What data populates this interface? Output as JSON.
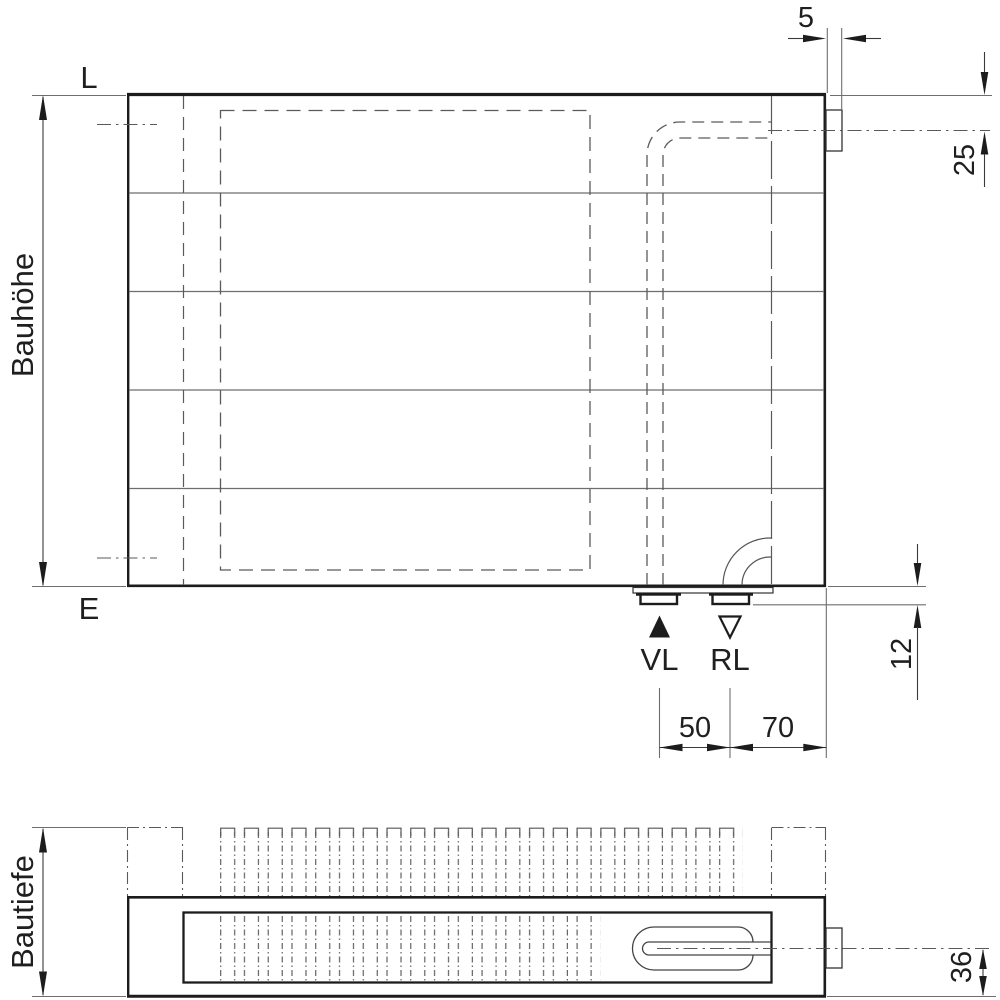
{
  "front_view": {
    "label_top_edge": "L",
    "label_bottom_edge": "E",
    "height_dimension_label": "Bauhöhe",
    "connection_flow_label": "VL",
    "connection_return_label": "RL",
    "dim_wall_clearance": "5",
    "dim_top_connection_offset": "25",
    "dim_bottom_connection_offset": "12",
    "dim_flow_return_spacing": "50",
    "dim_return_to_edge_spacing": "70"
  },
  "plan_view": {
    "depth_dimension_label": "Bautiefe",
    "dim_pipe_axis_to_bottom": "36"
  },
  "icons": {
    "flow_marker": "filled-triangle-up",
    "return_marker": "open-triangle-down"
  },
  "colors": {
    "outline": "#1c1c1c",
    "thin_line": "#6e6e6e",
    "hidden_line": "#5a5a5a",
    "dimension_line": "#3a3a3a",
    "text": "#1f1f1f",
    "background": "#ffffff"
  }
}
